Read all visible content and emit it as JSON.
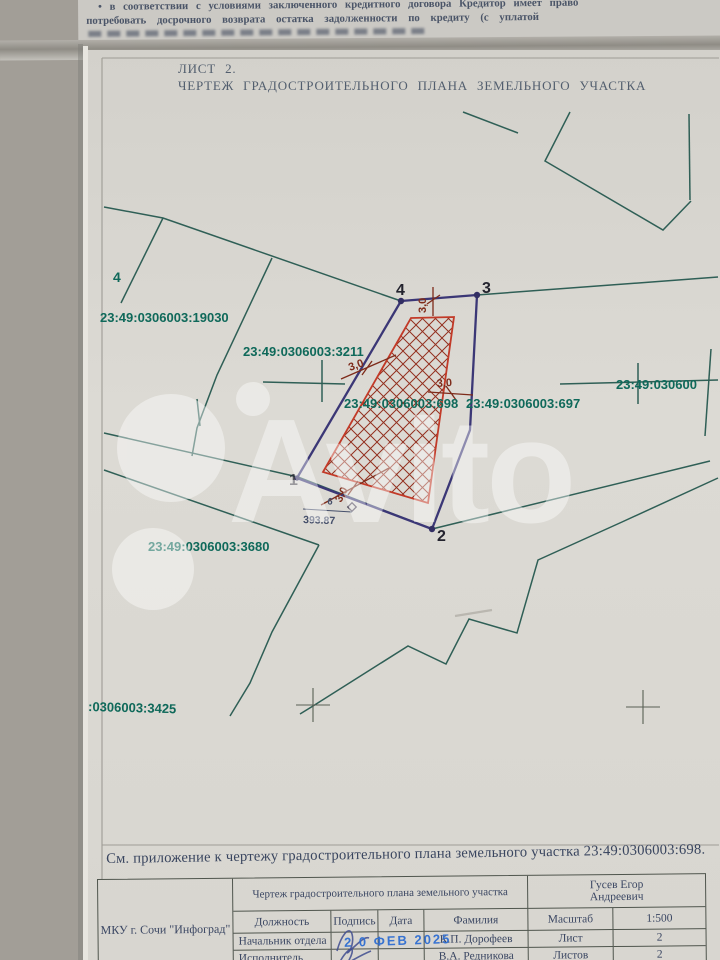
{
  "top_document": {
    "line1": "• в соответствии с условиями заключенного кредитного договора Кредитор имеет право",
    "line2": "потребовать досрочного возврата остатка задолженности по кредиту (с уплатой"
  },
  "sheet": {
    "title_line1": "ЛИСТ 2.",
    "title_line2": "ЧЕРТЕЖ ГРАДОСТРОИТЕЛЬНОГО ПЛАНА ЗЕМЕЛЬНОГО УЧАСТКА",
    "caption": "См. приложение к чертежу градостроительного плана земельного участка 23:49:0306003:698."
  },
  "map": {
    "labels": {
      "p19030": "23:49:0306003:19030",
      "p3211": "23:49:0306003:3211",
      "p698": "23:49:0306003:698",
      "p697": "23:49:0306003:697",
      "p_right_cut": "23:49:030600",
      "p3680": "23:49:0306003:3680",
      "p3425_cut": ":0306003:3425",
      "stray_point": "4"
    },
    "vertices": {
      "v1": "1",
      "v2": "2",
      "v3": "3",
      "v4": "4"
    },
    "dimensions": {
      "top": "3,0",
      "left": "3,0",
      "right": "3,0",
      "bottom": "3,0"
    },
    "benchmark": {
      "mark": "6",
      "elevation": "393.87"
    },
    "colors": {
      "boundary_teal": "#2f5f56",
      "parcel_purple": "#3b3776",
      "setback_red": "#c23a28",
      "hatch_red": "#93301f",
      "label_teal": "#0f695a"
    }
  },
  "watermark": {
    "text": "Avito"
  },
  "title_block": {
    "org": "МКУ г. Сочи \"Инфоград\"",
    "doc_title": "Чертеж градостроительного плана земельного участка",
    "author": "Гусев Егор Андреевич",
    "col_position": "Должность",
    "col_signature": "Подпись",
    "col_date": "Дата",
    "col_name": "Фамилия",
    "scale_label": "Масштаб",
    "scale_value": "1:500",
    "row1_position": "Начальник отдела",
    "row1_name": "К.П. Дорофеев",
    "sheet_label": "Лист",
    "sheet_value": "2",
    "row2_position": "Исполнитель",
    "row2_name": "В.А. Редникова",
    "sheets_label": "Листов",
    "sheets_value": "2",
    "date_stamp": "2 0 ФЕВ 2025"
  }
}
